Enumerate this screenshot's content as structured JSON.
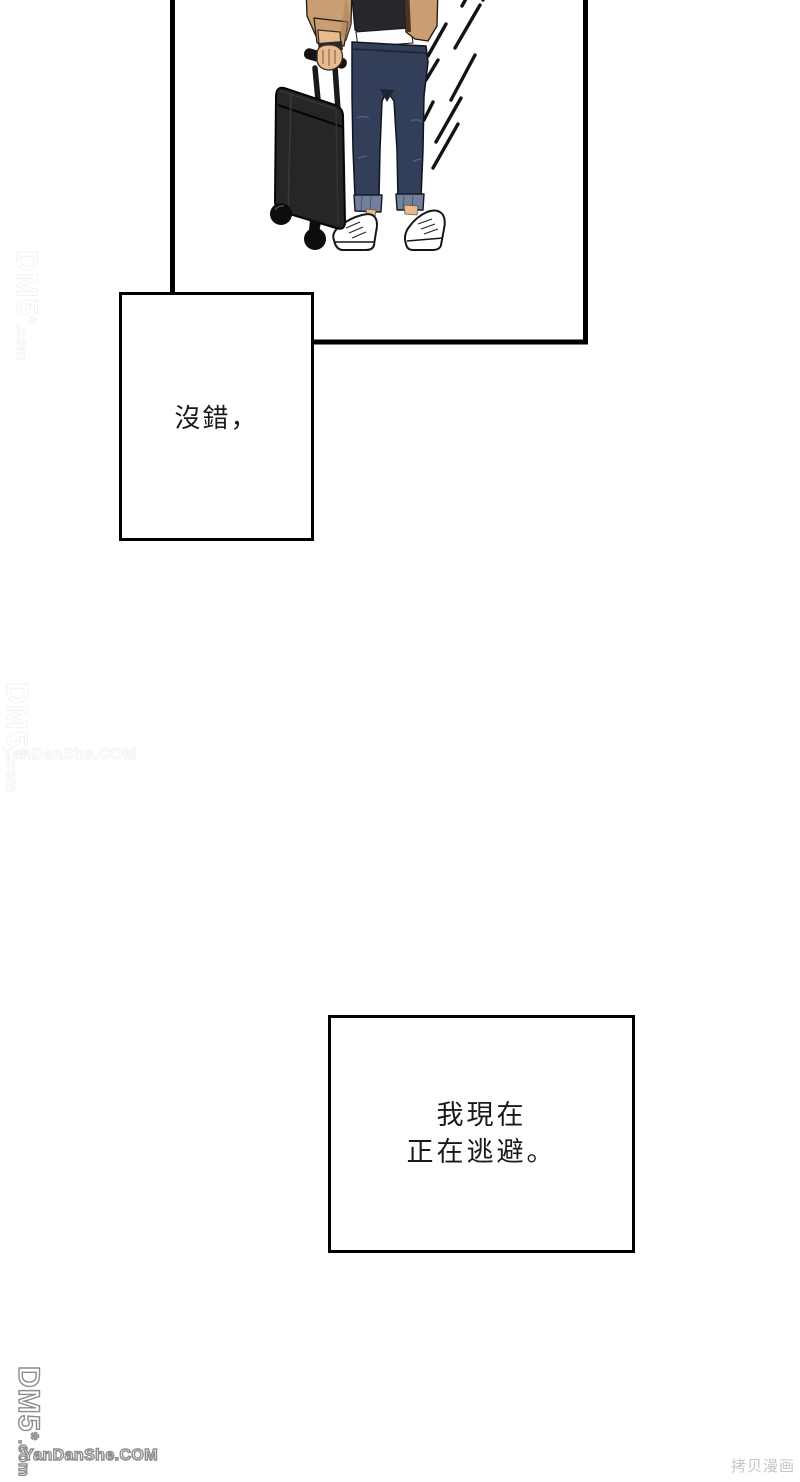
{
  "speech_boxes": [
    {
      "text": "沒錯，"
    },
    {
      "line1": "我現在",
      "line2": "正在逃避。"
    }
  ],
  "watermarks": {
    "dm5": "DM5",
    "dm5_star": "*",
    "dm5_com": ".com",
    "yandanshe": "YanDanShe.COM",
    "copy_label": "拷贝漫画"
  },
  "colors": {
    "jacket": "#c89e72",
    "jacketshadow": "#a8805a",
    "tee": "#26262b",
    "jeans": "#333e58",
    "jeansdark": "#1c2434",
    "crease": "#55648c",
    "cuff": "#72809c",
    "skin": "#e8ba90",
    "case": "#262626",
    "ink": "#131313"
  }
}
